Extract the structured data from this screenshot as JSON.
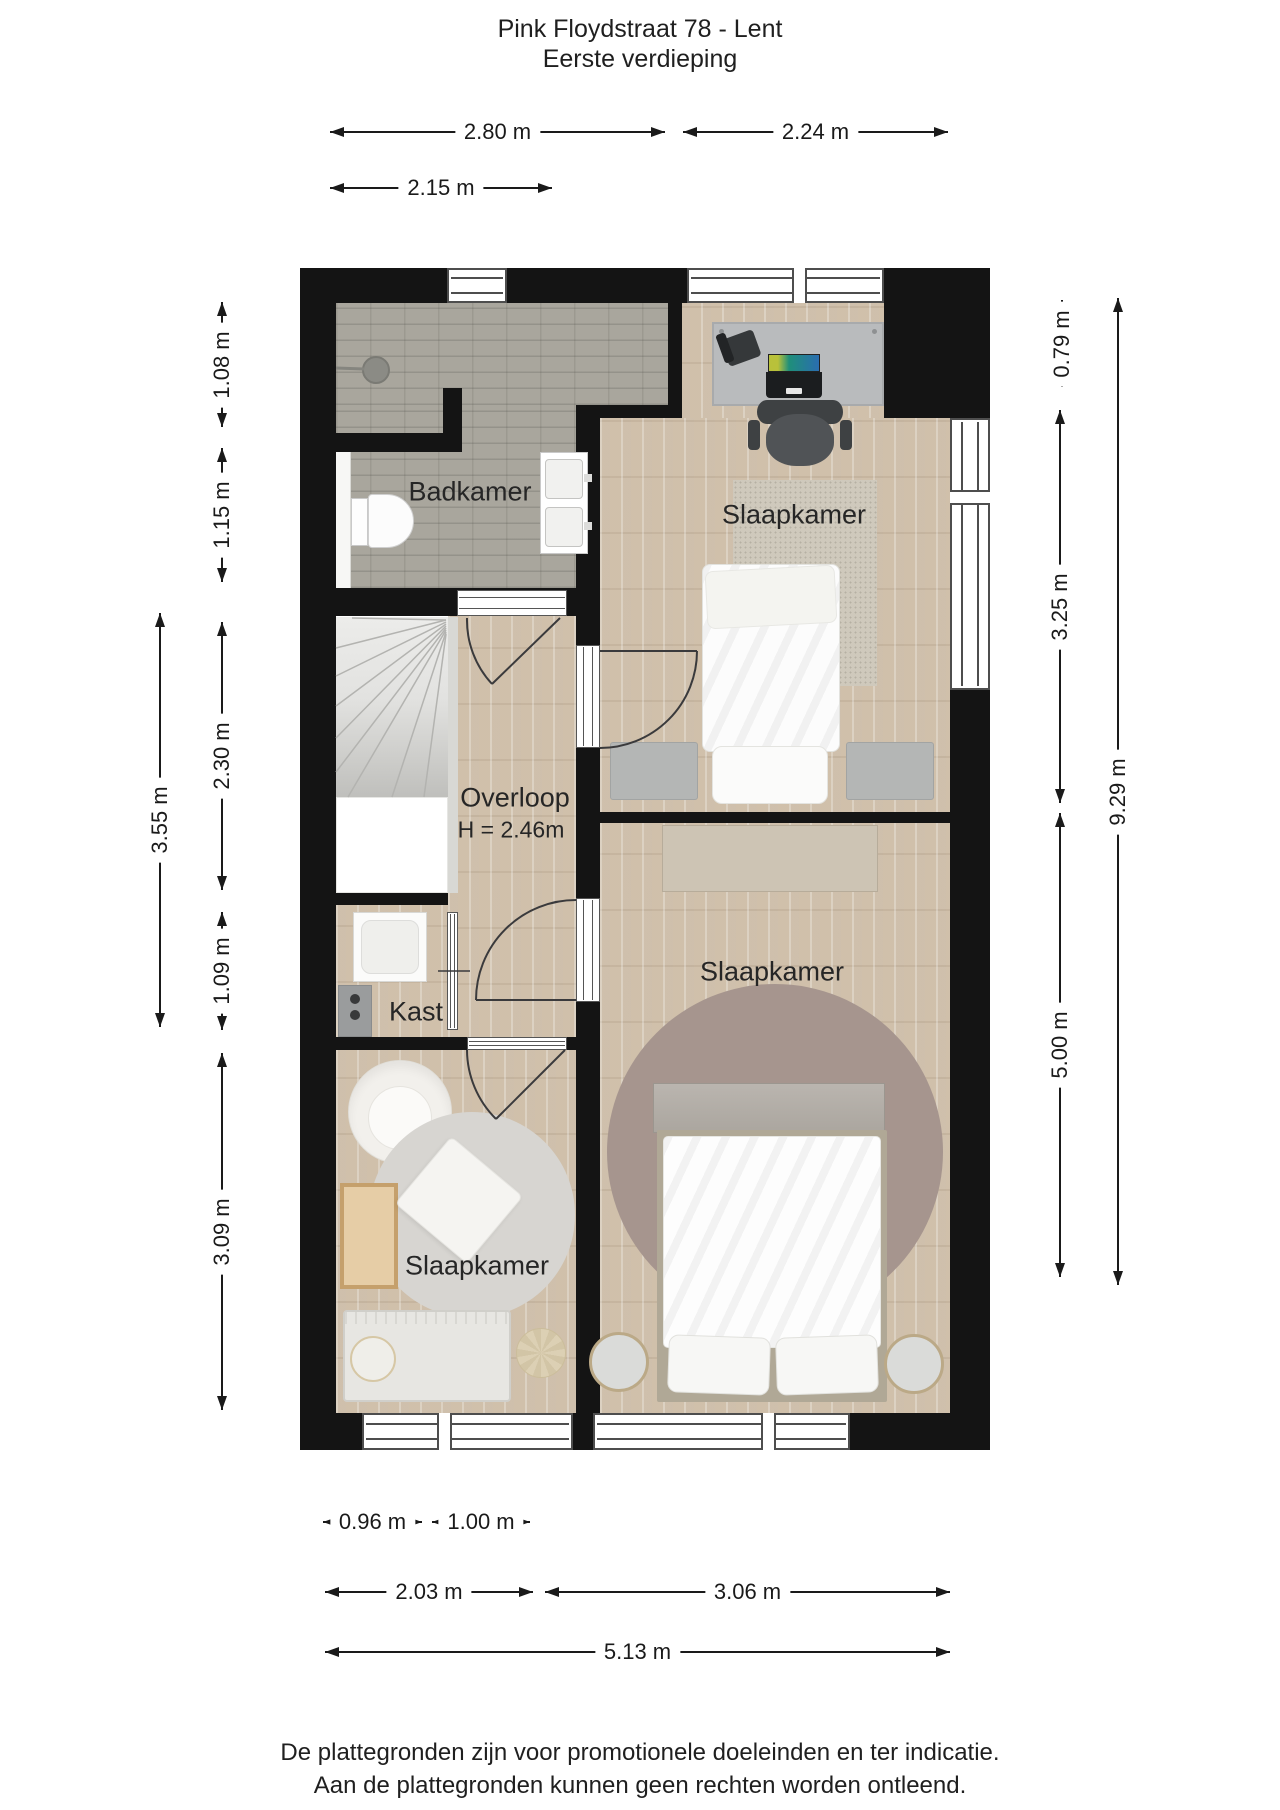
{
  "title": {
    "line1": "Pink Floydstraat 78 - Lent",
    "line2": "Eerste verdieping"
  },
  "rooms": {
    "badkamer": "Badkamer",
    "slaapkamer_top": "Slaapkamer",
    "overloop": "Overloop",
    "overloop_height": "H = 2.46m",
    "kast": "Kast",
    "slaapkamer_mid": "Slaapkamer",
    "slaapkamer_bottom": "Slaapkamer"
  },
  "dimensions": {
    "top": {
      "w1": "2.80 m",
      "w2": "2.24 m",
      "w3": "2.15 m"
    },
    "left": {
      "v1": "1.08 m",
      "v2": "1.15 m",
      "v3": "2.30 m",
      "v4": "1.09 m",
      "v5": "3.09 m",
      "v6": "3.55 m"
    },
    "right": {
      "v1": "0.79 m",
      "v2": "3.25 m",
      "v3": "5.00 m",
      "v4": "9.29 m"
    },
    "bottom": {
      "w1": "0.96 m",
      "w2": "1.00 m",
      "w3": "2.03 m",
      "w4": "3.06 m",
      "w5": "5.13 m"
    }
  },
  "footer": {
    "line1": "De plattegronden zijn voor promotionele doeleinden en ter indicatie.",
    "line2": "Aan de plattegronden kunnen geen rechten worden ontleend."
  },
  "colors": {
    "wall": "#141414",
    "wood_floor": "#d8cab7",
    "tile_floor": "#a9a69d",
    "mid_bedroom_rug": "#a6958e",
    "dimension_line": "#1a1a1a"
  }
}
